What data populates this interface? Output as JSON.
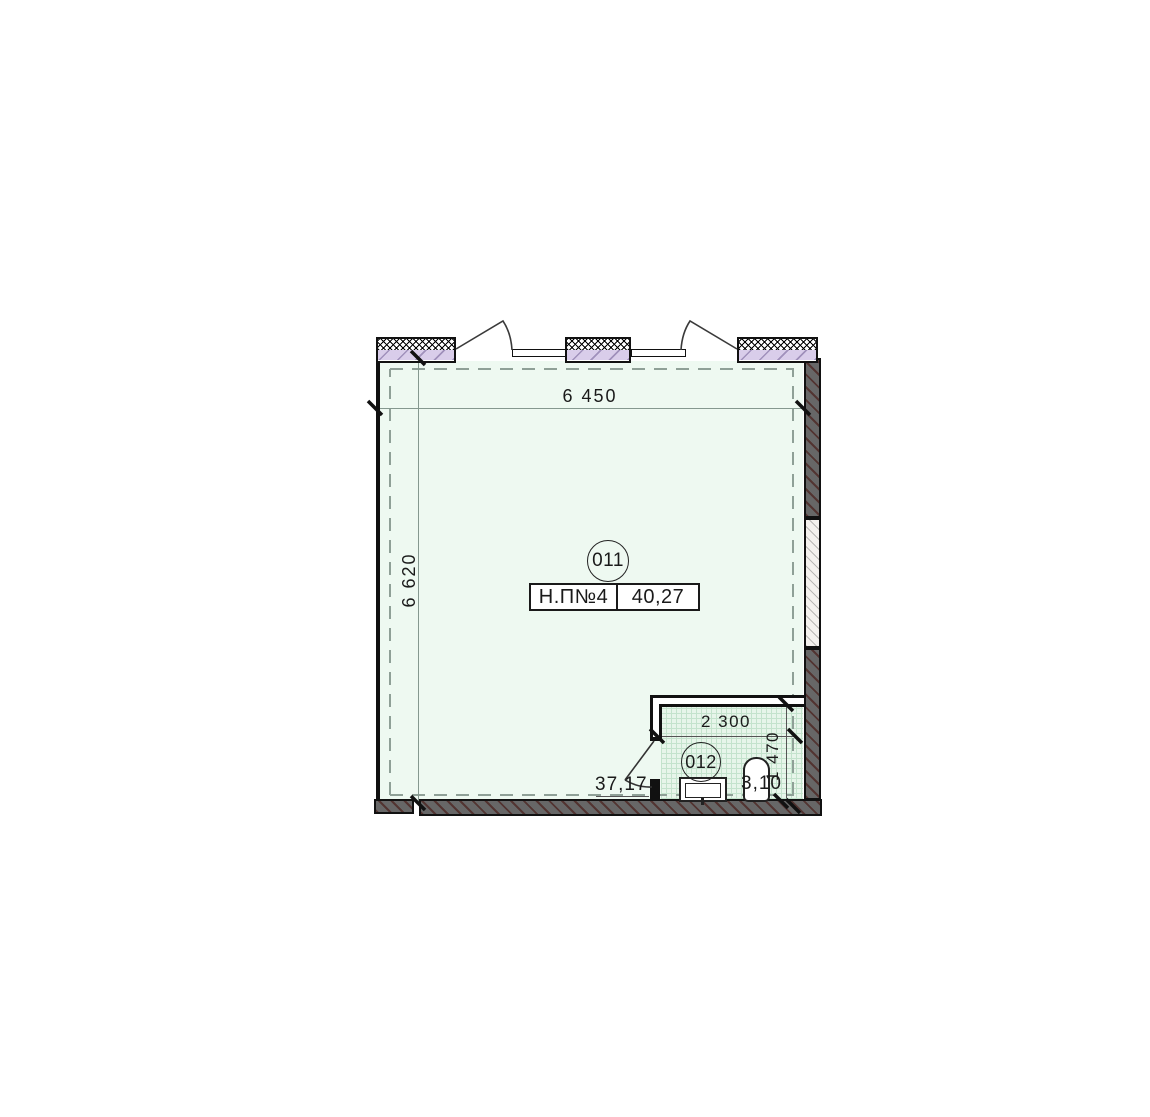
{
  "plan": {
    "main_room": {
      "number": "011",
      "name": "Н.П№4",
      "total_area": "40,27",
      "room_area": "37,17"
    },
    "bathroom": {
      "number": "012",
      "area": "3,10"
    },
    "dims": {
      "overall_width": "6 450",
      "overall_depth": "6 620",
      "bath_width": "2 300",
      "bath_depth": "1 470"
    },
    "colors": {
      "floor": "#eef9f1",
      "bath_floor": "#e7f5ea",
      "window_fill": "#d9cdea",
      "wall_fill": "#676767",
      "dash_line": "#8fa097"
    }
  }
}
